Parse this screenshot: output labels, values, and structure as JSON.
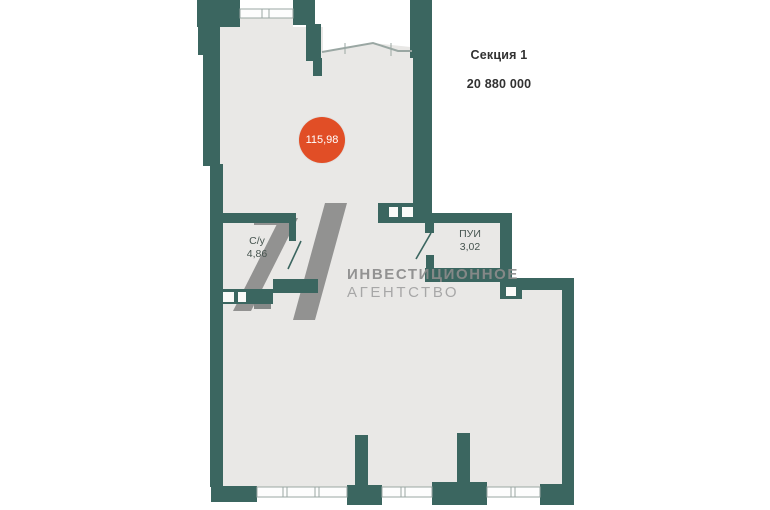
{
  "floor_plan": {
    "section": {
      "label": "Секция 1",
      "price": "20 880 000"
    },
    "total_area": "115,98",
    "rooms": [
      {
        "name": "С/у",
        "area": "4,86"
      },
      {
        "name": "ПУИ",
        "area": "3,02"
      }
    ],
    "watermark": {
      "agency_line1": "ИНВЕСТИЦИОННОЕ",
      "agency_line2": "АГЕНТСТВО"
    },
    "colors": {
      "wall_teal": "#3b6660",
      "floor_gray": "#e9e8e6",
      "area_badge_red": "#e14e26",
      "watermark_gray": "#8b8b8b",
      "heading_dark": "#313131"
    }
  }
}
